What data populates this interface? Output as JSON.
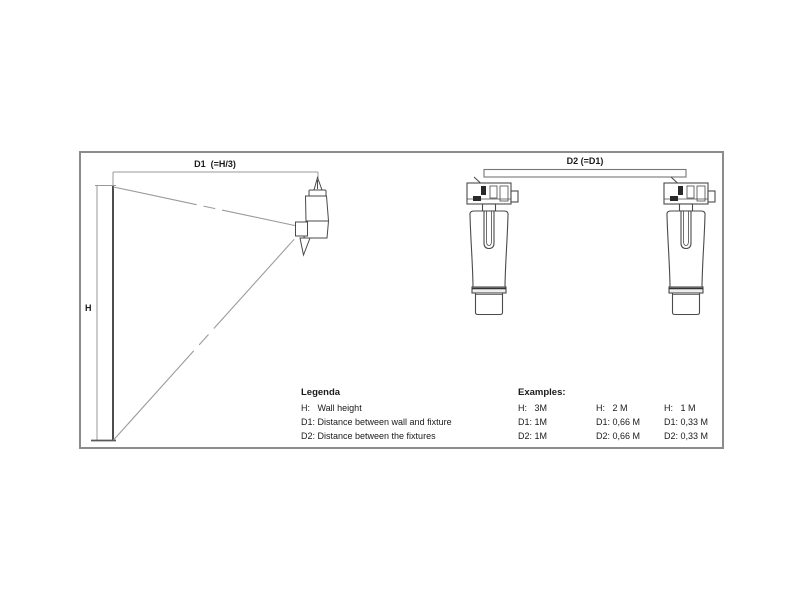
{
  "labels": {
    "d1": "D1  (=H/3)",
    "h": "H",
    "d2": "D2 (=D1)"
  },
  "legend": {
    "title": "Legenda",
    "items": [
      "H:   Wall height",
      "D1: Distance between wall and fixture",
      "D2: Distance between the fixtures"
    ]
  },
  "examples": {
    "title": "Examples:",
    "columns": [
      {
        "h": "H:   3M",
        "d1": "D1: 1M",
        "d2": "D2: 1M"
      },
      {
        "h": "H:   2 M",
        "d1": "D1: 0,66 M",
        "d2": "D2: 0,66 M"
      },
      {
        "h": "H:   1 M",
        "d1": "D1: 0,33 M",
        "d2": "D2: 0,33 M"
      }
    ]
  },
  "colors": {
    "line_dark": "#4a4a4a",
    "line_dim": "#999999",
    "frame": "#8c8c8c",
    "text": "#1a1a1a"
  }
}
